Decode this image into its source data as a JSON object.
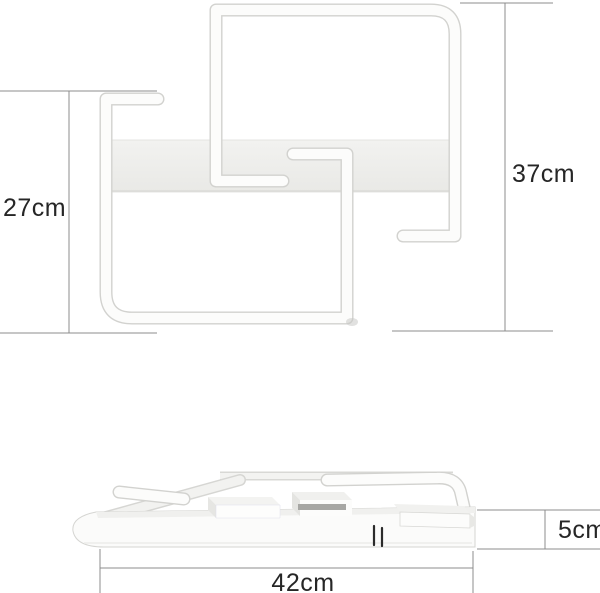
{
  "image": {
    "kind": "product dimension diagram",
    "subject": "white geometric square LED ceiling lamp",
    "background": "#ffffff"
  },
  "front_view": {
    "description": "two interlocking open square tube frames with rectangular mounting plate",
    "dimensions": {
      "height_lower_square": {
        "label": "27cm"
      },
      "height_overall": {
        "label": "37cm"
      }
    }
  },
  "side_view": {
    "description": "lamp lying flat seen from the side with raised square ring and boxes",
    "dimensions": {
      "width_overall": {
        "label": "42cm"
      },
      "thickness": {
        "label": "5cm"
      }
    }
  },
  "colors": {
    "lamp_white": "#fcfcfb",
    "lamp_outline_gray": "#d2d2cf",
    "plate_gray": "#efefec",
    "dimension_line_gray": "#8c8c8c",
    "label_text": "#262626"
  }
}
